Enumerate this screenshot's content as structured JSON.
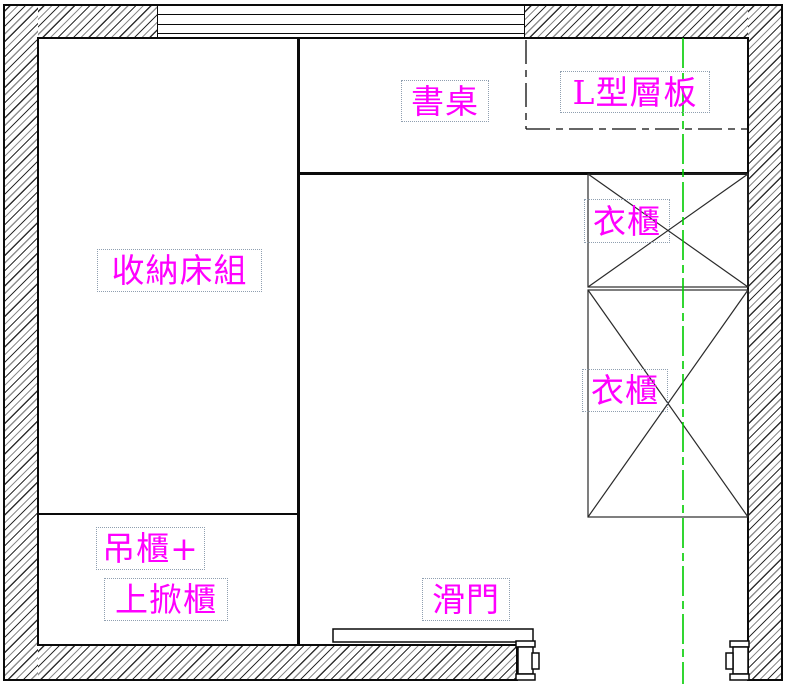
{
  "drawing": {
    "labels": {
      "storage_bed": "收納床組",
      "desk": "書桌",
      "l_shaped_shelf": "L型層板",
      "wardrobe_upper": "衣櫃",
      "wardrobe_lower": "衣櫃",
      "hanging_cabinet": "吊櫃+",
      "flip_up_cabinet": "上掀櫃",
      "sliding_door": "滑門"
    },
    "colors": {
      "label_text": "#FF00FF",
      "centerline": "#00CC00",
      "line": "#0a0a0a"
    }
  }
}
